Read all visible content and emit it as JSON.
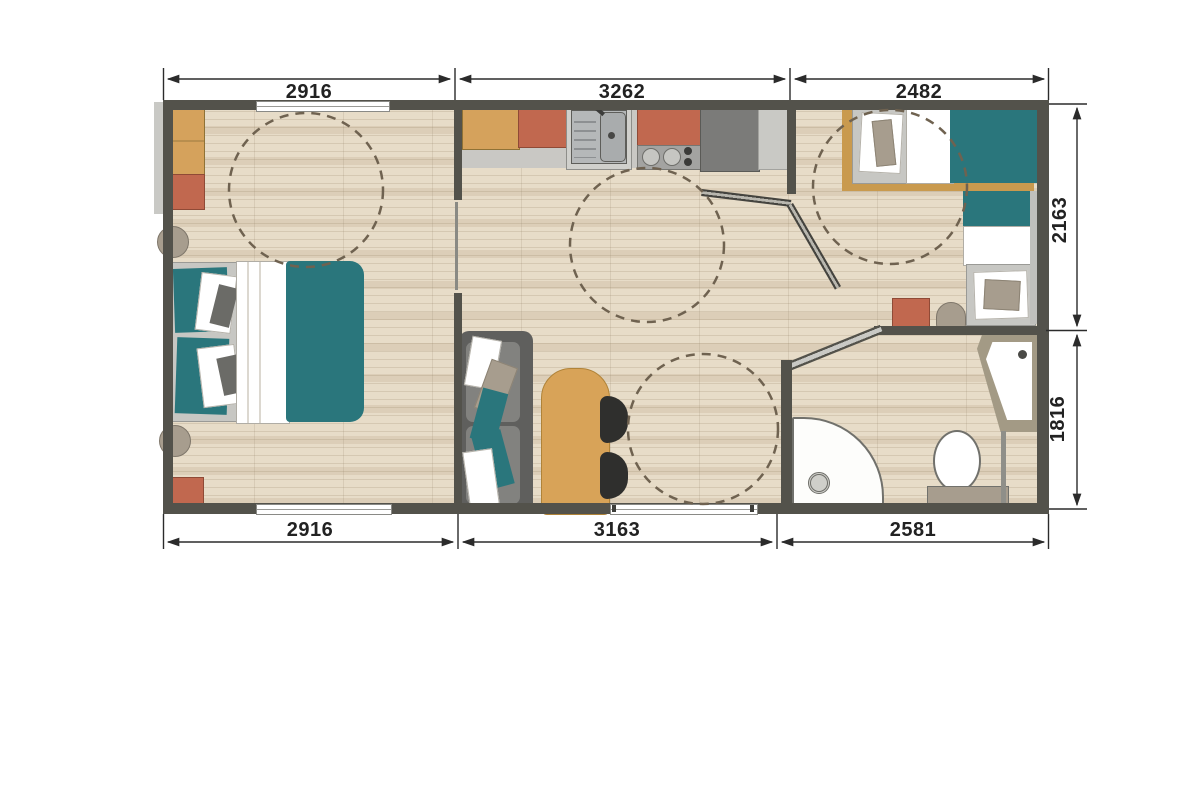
{
  "plan": {
    "dimensions_mm": {
      "top": [
        "2916",
        "3262",
        "2482"
      ],
      "bottom": [
        "2916",
        "3163",
        "2581"
      ],
      "right": [
        "2163",
        "1816"
      ]
    },
    "colors": {
      "wall": "#53524b",
      "floor": "#e7dcc8",
      "teal_accent": "#2a767c",
      "terracotta_accent": "#c1684f",
      "wood_accent": "#d5a25c",
      "dimension_text": "#222222",
      "turning_circle": "#6f6250"
    }
  }
}
